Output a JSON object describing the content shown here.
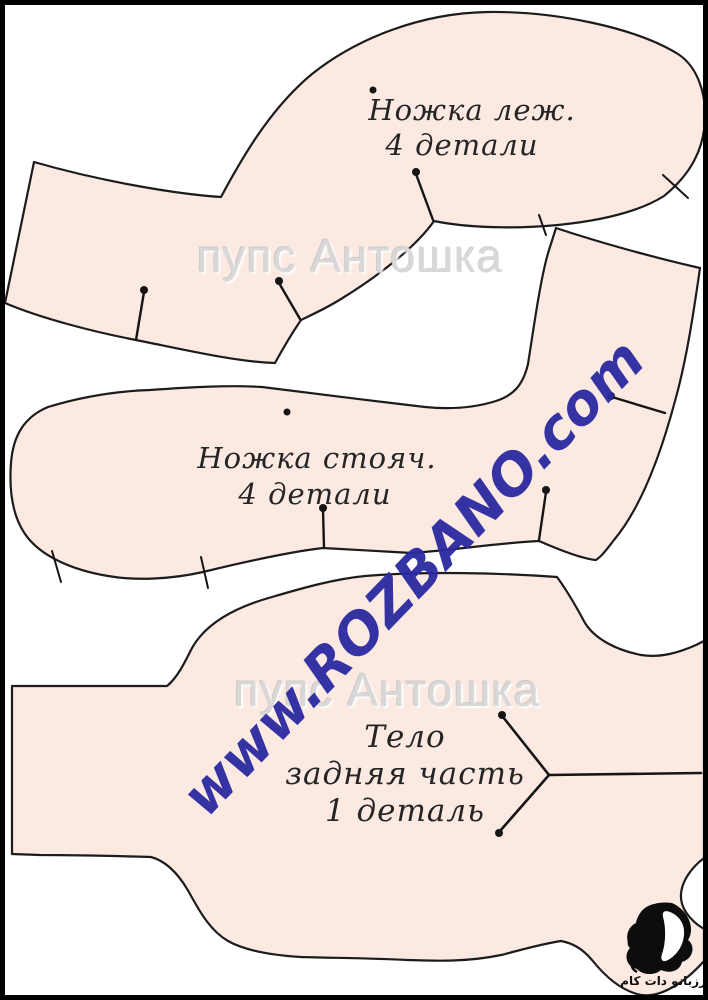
{
  "document": {
    "type": "doll-sewing-pattern-sheet"
  },
  "pieces": [
    {
      "name": "Ножка леж.",
      "quantity": "4 детали"
    },
    {
      "name": "Ножка стояч.",
      "quantity": "4 детали"
    },
    {
      "name": "Тело",
      "part": "задняя часть",
      "quantity": "1 деталь"
    }
  ],
  "watermarks": {
    "shop_name": "пупс Антошка",
    "website": "www.ROZBANO.com"
  },
  "logo": {
    "caption": "رزبانو دات کام"
  },
  "colors": {
    "piece_fill": "#fbe9e2",
    "outline": "#1c1c1c",
    "website_watermark": "#2b2aa0",
    "shop_watermark": "#d8d8d8",
    "frame": "#000000",
    "background": "#ffffff"
  }
}
